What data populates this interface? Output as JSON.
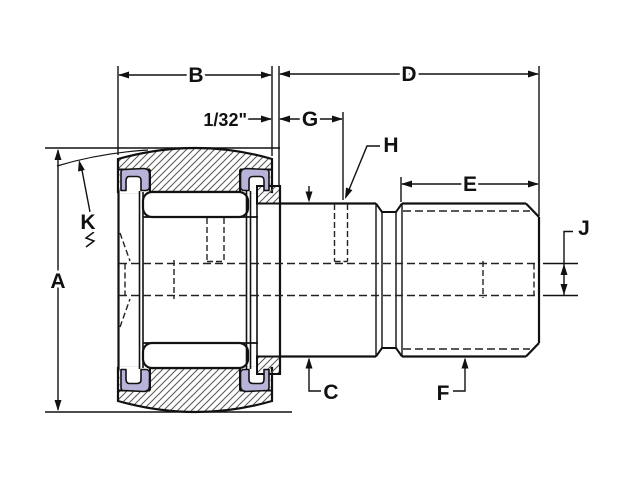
{
  "drawing": {
    "dimension_labels": {
      "a": "A",
      "b": "B",
      "c": "C",
      "d": "D",
      "e": "E",
      "f": "F",
      "g": "G",
      "h": "H",
      "j": "J",
      "k": "K",
      "offset": "1/32\""
    },
    "colors": {
      "background": "#ffffff",
      "line": "#111111",
      "hatch": "#555555",
      "seal": "#b7b3d9"
    }
  }
}
